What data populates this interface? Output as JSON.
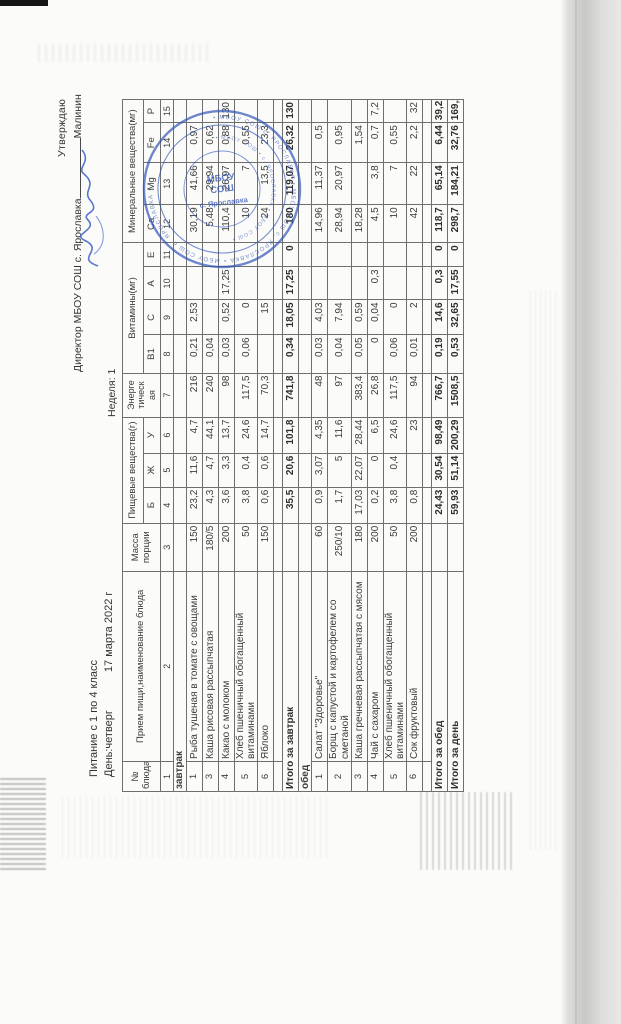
{
  "page": {
    "approval": {
      "line1": "Утверждаю",
      "line2_text": "Директор МБОУ СОШ с. Ярославка",
      "signer": "Малинин"
    },
    "title": "Питание с 1 по 4 класс",
    "day_label": "День:четверг",
    "date": "17 марта 2022 г",
    "week_label": "Неделя: 1"
  },
  "stamp": {
    "ring_outer": "• МБОУ СОШ с. ЯРОСЛАВКА • МБОУ СОШ с. ЯРОСЛАВКА • МБОУ СОШ с. ЯРОСЛАВКА •",
    "ring_inner": "• МБОУ СОШ • с. ЯРОСЛАВКА • МБОУ СОШ •",
    "center_line1": "МБОУ",
    "center_line2": "СОШ",
    "center_line3": "с. Ярославка",
    "color": "#2f54b8"
  },
  "table": {
    "headers": {
      "col_dish_num": "№ блюда",
      "col_dish_name": "Прием пищи,наименование блюда",
      "col_mass": "Масса порции",
      "group_nutrients": "Пищевые вещества(г)",
      "col_b": "Б",
      "col_zh": "Ж",
      "col_u": "У",
      "col_energy": "Энерге тическ ая",
      "group_vitamins": "Витамины(мг)",
      "col_b1": "В1",
      "col_c": "С",
      "col_a": "А",
      "col_e": "Е",
      "group_minerals": "Минеральные вещества(мг)",
      "col_ca": "Са",
      "col_mg": "Mg",
      "col_fe": "Fe",
      "col_p": "Р",
      "col_numbers": [
        "1",
        "2",
        "3",
        "4",
        "5",
        "6",
        "7",
        "8",
        "9",
        "10",
        "11",
        "12",
        "13",
        "14",
        "15"
      ]
    },
    "sections": [
      {
        "label": "завтрак",
        "rows": [
          {
            "num": "1",
            "name": "Рыба тушеная в томате с овощами",
            "values": [
              "150",
              "23,2",
              "11,6",
              "4,7",
              "216",
              "0,21",
              "2,53",
              "",
              "",
              "30,19",
              "41,66",
              "0,97",
              ""
            ]
          },
          {
            "num": "3",
            "name": "Каша рисовая рассыпчатая",
            "values": [
              "180/5",
              "4,3",
              "4,7",
              "44,1",
              "240",
              "0,04",
              "",
              "",
              "",
              "5,48",
              "29,94",
              "0,62",
              ""
            ]
          },
          {
            "num": "4",
            "name": "Какао с молоком",
            "values": [
              "200",
              "3,6",
              "3,3",
              "13,7",
              "98",
              "0,03",
              "0,52",
              "17,25",
              "",
              "110,4",
              "26,97",
              "0,88",
              "130"
            ]
          },
          {
            "num": "5",
            "name": "Хлеб пшеничный обогащенный витаминами",
            "values": [
              "50",
              "3,8",
              "0,4",
              "24,6",
              "117,5",
              "0,06",
              "0",
              "",
              "",
              "10",
              "7",
              "0,55",
              ""
            ]
          },
          {
            "num": "6",
            "name": "Яблоко",
            "values": [
              "150",
              "0,6",
              "0,6",
              "14,7",
              "70,3",
              "",
              "15",
              "",
              "",
              "24",
              "13,5",
              "23,3",
              ""
            ]
          }
        ],
        "total": {
          "label": "Итого за завтрак",
          "values": [
            "",
            "35,5",
            "20,6",
            "101,8",
            "741,8",
            "0,34",
            "18,05",
            "17,25",
            "0",
            "180",
            "119,07",
            "26,32",
            "130"
          ]
        }
      },
      {
        "label": "обед",
        "rows": [
          {
            "num": "1",
            "name": "Салат \"Здоровье\"",
            "values": [
              "60",
              "0,9",
              "3,07",
              "4,35",
              "48",
              "0,03",
              "4,03",
              "",
              "",
              "14,96",
              "11,37",
              "0,5",
              ""
            ]
          },
          {
            "num": "2",
            "name": "Борщ с капустой и картофелем со сметаной",
            "values": [
              "250/10",
              "1,7",
              "5",
              "11,6",
              "97",
              "0,04",
              "7,94",
              "",
              "",
              "28,94",
              "20,97",
              "0,95",
              ""
            ]
          },
          {
            "num": "3",
            "name": "Каша гречневая рассыпчатая с мясом",
            "values": [
              "180",
              "17,03",
              "22,07",
              "28,44",
              "383,4",
              "0,05",
              "0,59",
              "",
              "",
              "18,28",
              "",
              "1,54",
              ""
            ]
          },
          {
            "num": "4",
            "name": "Чай с сахаром",
            "values": [
              "200",
              "0,2",
              "0",
              "6,5",
              "26,8",
              "0",
              "0,04",
              "0,3",
              "",
              "4,5",
              "3,8",
              "0,7",
              "7,2"
            ]
          },
          {
            "num": "5",
            "name": "Хлеб пшеничный обогащенный витаминами",
            "values": [
              "50",
              "3,8",
              "0,4",
              "24,6",
              "117,5",
              "0,06",
              "0",
              "",
              "",
              "10",
              "7",
              "0,55",
              ""
            ]
          },
          {
            "num": "6",
            "name": "Сок фруктовый",
            "values": [
              "200",
              "0,8",
              "",
              "23",
              "94",
              "0,01",
              "2",
              "",
              "",
              "42",
              "22",
              "2,2",
              "32"
            ]
          }
        ],
        "total": {
          "label": "Итого за обед",
          "values": [
            "",
            "24,43",
            "30,54",
            "98,49",
            "766,7",
            "0,19",
            "14,6",
            "0,3",
            "0",
            "118,7",
            "65,14",
            "6,44",
            "39,2"
          ]
        }
      }
    ],
    "day_total": {
      "label": "Итого за день",
      "values": [
        "",
        "59,93",
        "51,14",
        "200,29",
        "1508,5",
        "0,53",
        "32,65",
        "17,55",
        "0",
        "298,7",
        "184,21",
        "32,76",
        "169,2"
      ]
    }
  }
}
